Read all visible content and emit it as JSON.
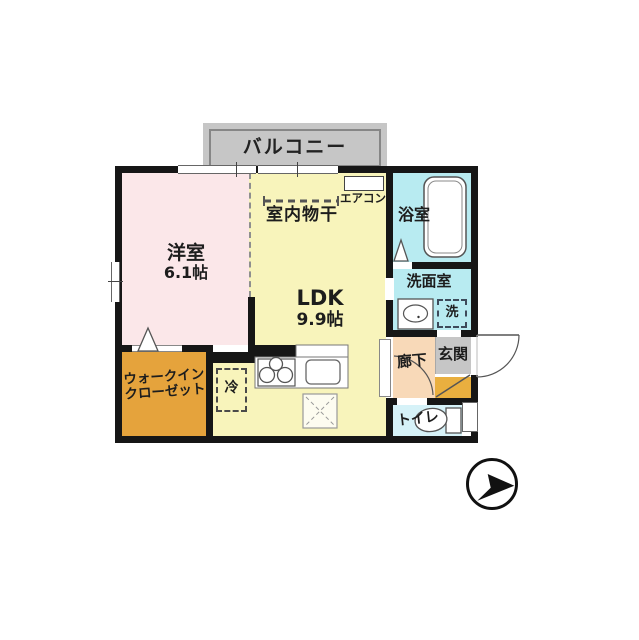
{
  "plan": {
    "balcony_label": "バルコニー",
    "western_room_label": "洋室",
    "western_room_size": "6.1帖",
    "ldk_label": "LDK",
    "ldk_size": "9.9帖",
    "indoor_drying_label": "室内物干",
    "aircon_label": "エアコン",
    "bathroom_label": "浴室",
    "washroom_label": "洗面室",
    "washer_label": "洗",
    "hallway_label": "廊下",
    "entrance_label": "玄関",
    "toilet_label": "トイレ",
    "wic_label_line1": "ウォークイン",
    "wic_label_line2": "クローゼット",
    "fridge_label": "冷"
  },
  "colors": {
    "wall": "#161616",
    "western_room": "#fbe7e9",
    "ldk": "#f8f4bb",
    "bathroom": "#b8ebf1",
    "washroom": "#b8ebf1",
    "toilet": "#d6f2f8",
    "hallway": "#f8d9b8",
    "entrance_tile": "#c6c6c6",
    "entrance_step": "#e9af3f",
    "walk_in_closet": "#e5a33c",
    "balcony": "#c6c6c6"
  },
  "icons": {
    "compass": "north-arrow-circle",
    "bathtub": "bathtub-outline",
    "toilet": "toilet-seat",
    "stove": "three-burner-stove",
    "sink": "kitchen-sink",
    "basin": "wash-basin",
    "drying_pole": "indoor-drying-pole"
  }
}
